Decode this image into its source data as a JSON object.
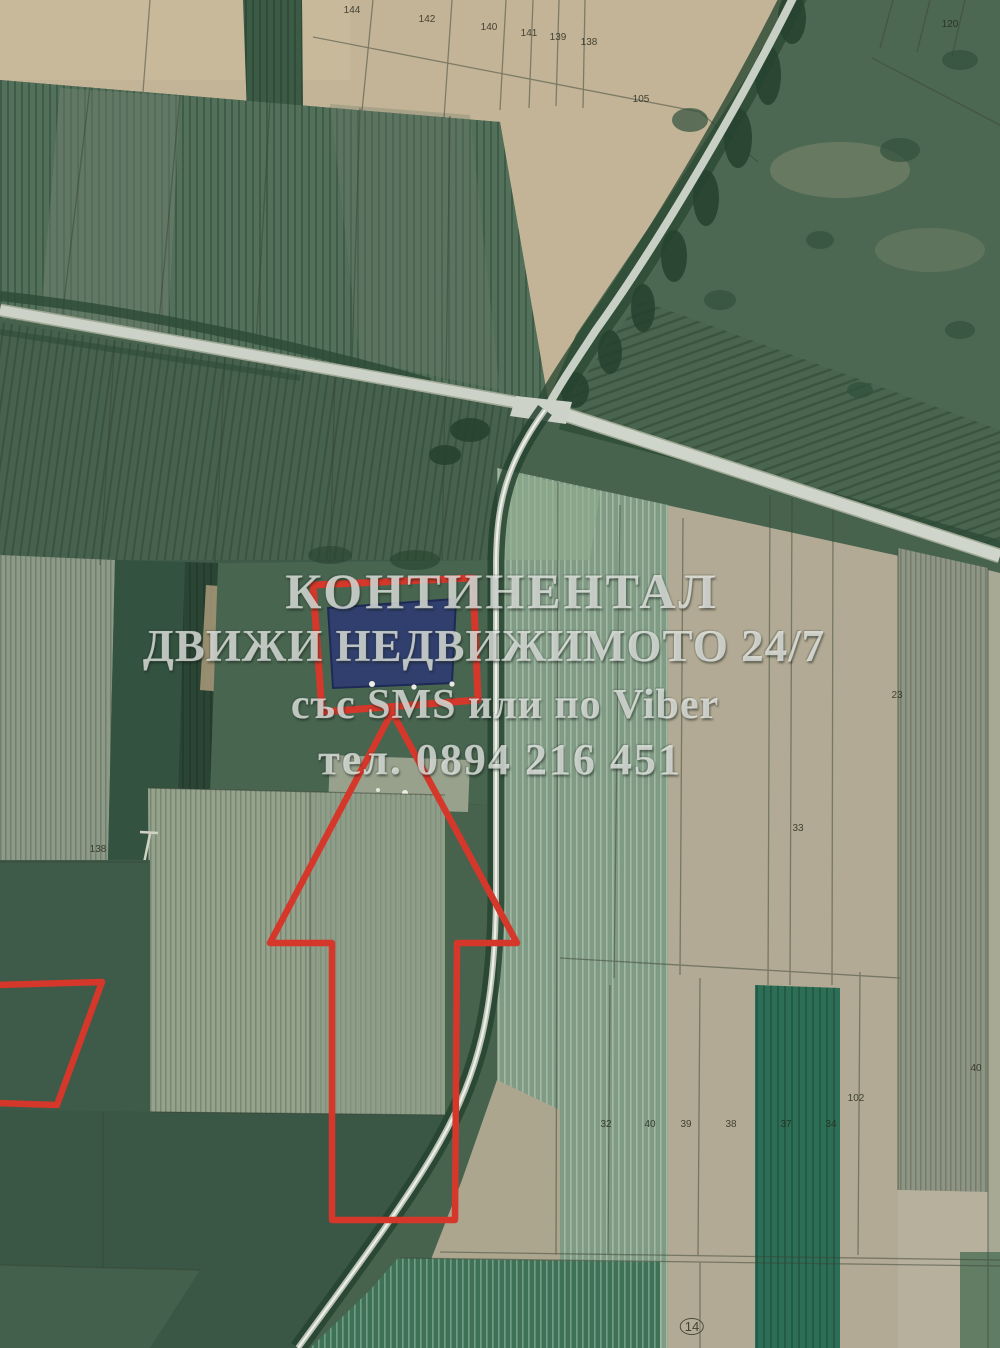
{
  "page": {
    "title": "Satellite cadastral map — real estate listing photo"
  },
  "map": {
    "kind": "aerial-photo-with-cadastre",
    "watermark": {
      "line1": "КОНТИНЕНТАЛ",
      "line2": "ДВИЖИ НЕДВИЖИМОТО 24/7",
      "line3": "със SMS или по Viber",
      "line4": "тел. 0894 216 451"
    },
    "colors": {
      "annotation_red": "#d5382b",
      "parcel_blue": "#2c3a72",
      "parcel_blue_stroke": "#1e2a55",
      "road_light": "#ccd2c8",
      "field_tan": "#c3b497",
      "field_green_dark": "#3f5a48",
      "field_green_pale": "#7f9b84"
    },
    "annotations": {
      "highlighted_parcel": "blue filled parcel outlined in red",
      "arrow": "large red outline arrow pointing up at the highlighted parcel",
      "left_outline": "red parcel outline clipped at left edge"
    },
    "parcel_labels": [
      {
        "text": "144",
        "x": 352,
        "y": 6
      },
      {
        "text": "142",
        "x": 427,
        "y": 15
      },
      {
        "text": "140",
        "x": 489,
        "y": 23
      },
      {
        "text": "141",
        "x": 529,
        "y": 29
      },
      {
        "text": "139",
        "x": 558,
        "y": 33
      },
      {
        "text": "138",
        "x": 589,
        "y": 38
      },
      {
        "text": "105",
        "x": 641,
        "y": 95
      },
      {
        "text": "120",
        "x": 950,
        "y": 20
      },
      {
        "text": "23",
        "x": 897,
        "y": 691
      },
      {
        "text": "33",
        "x": 798,
        "y": 824
      },
      {
        "text": "138",
        "x": 98,
        "y": 845
      },
      {
        "text": "102",
        "x": 856,
        "y": 1094
      },
      {
        "text": "32",
        "x": 606,
        "y": 1120
      },
      {
        "text": "40",
        "x": 650,
        "y": 1120
      },
      {
        "text": "39",
        "x": 686,
        "y": 1120
      },
      {
        "text": "38",
        "x": 731,
        "y": 1120
      },
      {
        "text": "37",
        "x": 786,
        "y": 1120
      },
      {
        "text": "34",
        "x": 831,
        "y": 1120
      },
      {
        "text": "40",
        "x": 976,
        "y": 1064
      },
      {
        "text": "14",
        "x": 692,
        "y": 1318,
        "circled": true
      }
    ]
  }
}
